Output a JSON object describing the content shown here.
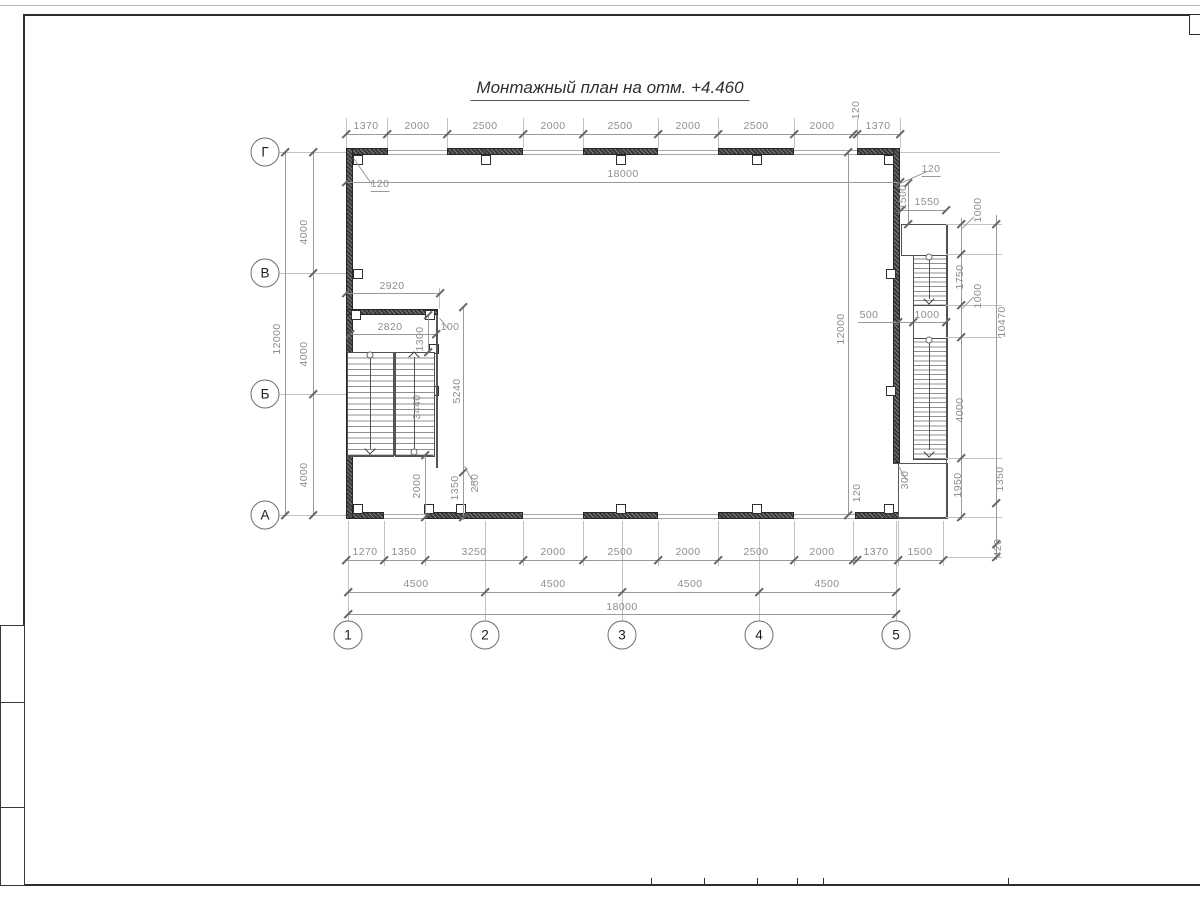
{
  "header": {
    "title": "Монтажный план на отм. +4.460"
  },
  "axes": {
    "rows": [
      {
        "label": "Г",
        "x": 265,
        "y": 152
      },
      {
        "label": "В",
        "x": 265,
        "y": 273
      },
      {
        "label": "Б",
        "x": 265,
        "y": 394
      },
      {
        "label": "А",
        "x": 265,
        "y": 515
      }
    ],
    "cols": [
      {
        "label": "1",
        "x": 348,
        "y": 635
      },
      {
        "label": "2",
        "x": 485,
        "y": 635
      },
      {
        "label": "3",
        "x": 622,
        "y": 635
      },
      {
        "label": "4",
        "x": 759,
        "y": 635
      },
      {
        "label": "5",
        "x": 896,
        "y": 635
      }
    ]
  },
  "drawing": {
    "labels": [
      {
        "t": "1370",
        "x": 366,
        "y": 126
      },
      {
        "t": "2000",
        "x": 417,
        "y": 126
      },
      {
        "t": "2500",
        "x": 485,
        "y": 126
      },
      {
        "t": "2000",
        "x": 553,
        "y": 126
      },
      {
        "t": "2500",
        "x": 620,
        "y": 126
      },
      {
        "t": "2000",
        "x": 688,
        "y": 126
      },
      {
        "t": "2500",
        "x": 756,
        "y": 126
      },
      {
        "t": "2000",
        "x": 822,
        "y": 126
      },
      {
        "t": "120",
        "x": 856,
        "y": 110,
        "r": 1
      },
      {
        "t": "1370",
        "x": 878,
        "y": 126
      },
      {
        "t": "18000",
        "x": 623,
        "y": 174
      },
      {
        "t": "120",
        "x": 380,
        "y": 185,
        "u": 1
      },
      {
        "t": "4000",
        "x": 304,
        "y": 232,
        "r": 1
      },
      {
        "t": "4000",
        "x": 304,
        "y": 354,
        "r": 1
      },
      {
        "t": "4000",
        "x": 304,
        "y": 475,
        "r": 1
      },
      {
        "t": "12000",
        "x": 277,
        "y": 339,
        "r": 1
      },
      {
        "t": "2920",
        "x": 392,
        "y": 286
      },
      {
        "t": "2820",
        "x": 390,
        "y": 327
      },
      {
        "t": "1300",
        "x": 420,
        "y": 339,
        "r": 1
      },
      {
        "t": "100",
        "x": 450,
        "y": 327
      },
      {
        "t": "3440",
        "x": 417,
        "y": 407,
        "r": 1
      },
      {
        "t": "5240",
        "x": 457,
        "y": 391,
        "r": 1
      },
      {
        "t": "2000",
        "x": 417,
        "y": 486,
        "r": 1
      },
      {
        "t": "1350",
        "x": 455,
        "y": 488,
        "r": 1
      },
      {
        "t": "250",
        "x": 475,
        "y": 483,
        "r": 1
      },
      {
        "t": "12000",
        "x": 841,
        "y": 329,
        "r": 1
      },
      {
        "t": "500",
        "x": 869,
        "y": 315
      },
      {
        "t": "1000",
        "x": 927,
        "y": 315
      },
      {
        "t": "120",
        "x": 931,
        "y": 170,
        "u": 1
      },
      {
        "t": "1500",
        "x": 903,
        "y": 197,
        "r": 1
      },
      {
        "t": "1550",
        "x": 927,
        "y": 202
      },
      {
        "t": "1000",
        "x": 978,
        "y": 210,
        "r": 1
      },
      {
        "t": "1750",
        "x": 960,
        "y": 277,
        "r": 1
      },
      {
        "t": "1000",
        "x": 978,
        "y": 296,
        "r": 1
      },
      {
        "t": "10470",
        "x": 1002,
        "y": 322,
        "r": 1
      },
      {
        "t": "4000",
        "x": 960,
        "y": 410,
        "r": 1
      },
      {
        "t": "1950",
        "x": 958,
        "y": 485,
        "r": 1
      },
      {
        "t": "300",
        "x": 905,
        "y": 480,
        "r": 1
      },
      {
        "t": "1350",
        "x": 1000,
        "y": 479,
        "r": 1
      },
      {
        "t": "120",
        "x": 857,
        "y": 493,
        "r": 1
      },
      {
        "t": "420",
        "x": 998,
        "y": 548,
        "r": 1
      },
      {
        "t": "1270",
        "x": 365,
        "y": 552
      },
      {
        "t": "1350",
        "x": 404,
        "y": 552
      },
      {
        "t": "3250",
        "x": 474,
        "y": 552
      },
      {
        "t": "2000",
        "x": 553,
        "y": 552
      },
      {
        "t": "2500",
        "x": 620,
        "y": 552
      },
      {
        "t": "2000",
        "x": 688,
        "y": 552
      },
      {
        "t": "2500",
        "x": 756,
        "y": 552
      },
      {
        "t": "2000",
        "x": 822,
        "y": 552
      },
      {
        "t": "1370",
        "x": 876,
        "y": 552
      },
      {
        "t": "1500",
        "x": 920,
        "y": 552
      },
      {
        "t": "4500",
        "x": 416,
        "y": 584
      },
      {
        "t": "4500",
        "x": 553,
        "y": 584
      },
      {
        "t": "4500",
        "x": 690,
        "y": 584
      },
      {
        "t": "4500",
        "x": 827,
        "y": 584
      },
      {
        "t": "18000",
        "x": 622,
        "y": 607
      }
    ],
    "dimlines": [
      {
        "o": "h",
        "x": 346,
        "y": 134,
        "l": 554,
        "tk": [
          346,
          387,
          447,
          523,
          583,
          658,
          718,
          794,
          853,
          857,
          900
        ]
      },
      {
        "o": "h",
        "x": 346,
        "y": 182,
        "l": 554,
        "tk": [
          346,
          900
        ]
      },
      {
        "o": "h",
        "x": 346,
        "y": 293,
        "l": 94,
        "tk": [
          346,
          440
        ]
      },
      {
        "o": "h",
        "x": 350,
        "y": 334,
        "l": 86,
        "tk": [
          350,
          436
        ]
      },
      {
        "o": "h",
        "x": 901,
        "y": 210,
        "l": 45,
        "tk": [
          901,
          946
        ]
      },
      {
        "o": "h",
        "x": 858,
        "y": 322,
        "l": 88,
        "tk": [
          898,
          913,
          946
        ]
      },
      {
        "o": "h",
        "x": 346,
        "y": 560,
        "l": 597,
        "tk": [
          346,
          384,
          425,
          523,
          583,
          658,
          718,
          794,
          853,
          857,
          898,
          943
        ]
      },
      {
        "o": "h",
        "x": 348,
        "y": 592,
        "l": 548,
        "tk": [
          348,
          485,
          622,
          759,
          896
        ]
      },
      {
        "o": "h",
        "x": 348,
        "y": 614,
        "l": 548,
        "tk": [
          348,
          896
        ]
      },
      {
        "o": "v",
        "x": 285,
        "y": 152,
        "l": 363,
        "tk": [
          152,
          515
        ]
      },
      {
        "o": "v",
        "x": 313,
        "y": 152,
        "l": 363,
        "tk": [
          152,
          273,
          394,
          515
        ]
      },
      {
        "o": "v",
        "x": 848,
        "y": 152,
        "l": 363,
        "tk": [
          152,
          515
        ]
      },
      {
        "o": "v",
        "x": 961,
        "y": 218,
        "l": 302,
        "tk": [
          224,
          254,
          305,
          337,
          458,
          517
        ]
      },
      {
        "o": "v",
        "x": 996,
        "y": 215,
        "l": 345,
        "tk": [
          224,
          503,
          544,
          557
        ]
      },
      {
        "o": "v",
        "x": 463,
        "y": 307,
        "l": 213,
        "tk": [
          307,
          472,
          517
        ]
      },
      {
        "o": "v",
        "x": 428,
        "y": 315,
        "l": 37,
        "tk": [
          315,
          352
        ]
      },
      {
        "o": "v",
        "x": 425,
        "y": 455,
        "l": 62,
        "tk": [
          455,
          517
        ]
      },
      {
        "o": "v",
        "x": 908,
        "y": 183,
        "l": 41,
        "tk": [
          183,
          224
        ]
      }
    ],
    "extlines": [
      {
        "o": "v",
        "x": 346,
        "y": 118,
        "l": 30
      },
      {
        "o": "v",
        "x": 387,
        "y": 118,
        "l": 30
      },
      {
        "o": "v",
        "x": 447,
        "y": 118,
        "l": 30
      },
      {
        "o": "v",
        "x": 523,
        "y": 118,
        "l": 30
      },
      {
        "o": "v",
        "x": 583,
        "y": 118,
        "l": 30
      },
      {
        "o": "v",
        "x": 658,
        "y": 118,
        "l": 30
      },
      {
        "o": "v",
        "x": 718,
        "y": 118,
        "l": 30
      },
      {
        "o": "v",
        "x": 794,
        "y": 118,
        "l": 30
      },
      {
        "o": "v",
        "x": 857,
        "y": 118,
        "l": 30
      },
      {
        "o": "v",
        "x": 900,
        "y": 118,
        "l": 30
      },
      {
        "o": "h",
        "x": 279,
        "y": 152,
        "l": 67
      },
      {
        "o": "h",
        "x": 279,
        "y": 273,
        "l": 67
      },
      {
        "o": "h",
        "x": 279,
        "y": 394,
        "l": 67
      },
      {
        "o": "h",
        "x": 279,
        "y": 515,
        "l": 67
      },
      {
        "o": "v",
        "x": 384,
        "y": 521,
        "l": 45
      },
      {
        "o": "v",
        "x": 425,
        "y": 521,
        "l": 45
      },
      {
        "o": "v",
        "x": 523,
        "y": 521,
        "l": 45
      },
      {
        "o": "v",
        "x": 583,
        "y": 521,
        "l": 45
      },
      {
        "o": "v",
        "x": 658,
        "y": 521,
        "l": 45
      },
      {
        "o": "v",
        "x": 718,
        "y": 521,
        "l": 45
      },
      {
        "o": "v",
        "x": 794,
        "y": 521,
        "l": 45
      },
      {
        "o": "v",
        "x": 853,
        "y": 521,
        "l": 45
      },
      {
        "o": "v",
        "x": 898,
        "y": 521,
        "l": 45
      },
      {
        "o": "v",
        "x": 943,
        "y": 521,
        "l": 45
      },
      {
        "o": "v",
        "x": 348,
        "y": 521,
        "l": 100
      },
      {
        "o": "v",
        "x": 485,
        "y": 521,
        "l": 100
      },
      {
        "o": "v",
        "x": 622,
        "y": 521,
        "l": 100
      },
      {
        "o": "v",
        "x": 759,
        "y": 521,
        "l": 100
      },
      {
        "o": "v",
        "x": 896,
        "y": 521,
        "l": 100
      },
      {
        "o": "h",
        "x": 946,
        "y": 224,
        "l": 56
      },
      {
        "o": "h",
        "x": 946,
        "y": 254,
        "l": 56
      },
      {
        "o": "h",
        "x": 946,
        "y": 305,
        "l": 56
      },
      {
        "o": "h",
        "x": 946,
        "y": 337,
        "l": 56
      },
      {
        "o": "h",
        "x": 946,
        "y": 458,
        "l": 56
      },
      {
        "o": "h",
        "x": 946,
        "y": 517,
        "l": 56
      },
      {
        "o": "h",
        "x": 900,
        "y": 152,
        "l": 100
      },
      {
        "o": "h",
        "x": 946,
        "y": 557,
        "l": 56
      },
      {
        "o": "v",
        "x": 439,
        "y": 288,
        "l": 21
      }
    ],
    "edges": [
      {
        "o": "h",
        "x": 898,
        "y": 463,
        "l": 48
      },
      {
        "o": "v",
        "x": 898,
        "y": 463,
        "l": 54
      },
      {
        "o": "h",
        "x": 898,
        "y": 517,
        "l": 48
      },
      {
        "o": "v",
        "x": 946,
        "y": 224,
        "l": 293
      },
      {
        "o": "h",
        "x": 893,
        "y": 463,
        "l": 20
      },
      {
        "o": "v",
        "x": 393,
        "y": 352,
        "l": 103,
        "t": 2
      },
      {
        "o": "v",
        "x": 436,
        "y": 315,
        "l": 153,
        "t": 2
      },
      {
        "o": "h",
        "x": 347,
        "y": 455,
        "l": 86
      }
    ],
    "dirlines": [
      {
        "o": "v",
        "x": 370,
        "y": 356,
        "l": 93
      },
      {
        "o": "v",
        "x": 414,
        "y": 357,
        "l": 95
      },
      {
        "o": "v",
        "x": 929,
        "y": 258,
        "l": 41
      },
      {
        "o": "v",
        "x": 929,
        "y": 341,
        "l": 109
      }
    ],
    "leaders": [
      {
        "x": 354,
        "y": 158,
        "l": 32,
        "deg": 55
      },
      {
        "x": 900,
        "y": 183,
        "l": 30,
        "deg": -24
      },
      {
        "x": 465,
        "y": 466,
        "l": 24,
        "deg": 62
      },
      {
        "x": 962,
        "y": 228,
        "l": 16,
        "deg": -45
      },
      {
        "x": 962,
        "y": 308,
        "l": 16,
        "deg": -45
      },
      {
        "x": 440,
        "y": 318,
        "l": 14,
        "deg": 50
      },
      {
        "x": 899,
        "y": 466,
        "l": 16,
        "deg": 60
      }
    ],
    "walls": [
      {
        "x": 346,
        "y": 148,
        "w": 42,
        "h": 7
      },
      {
        "x": 447,
        "y": 148,
        "w": 76,
        "h": 7
      },
      {
        "x": 583,
        "y": 148,
        "w": 75,
        "h": 7
      },
      {
        "x": 718,
        "y": 148,
        "w": 76,
        "h": 7
      },
      {
        "x": 857,
        "y": 148,
        "w": 43,
        "h": 7
      },
      {
        "x": 346,
        "y": 512,
        "w": 38,
        "h": 7
      },
      {
        "x": 425,
        "y": 512,
        "w": 98,
        "h": 7
      },
      {
        "x": 583,
        "y": 512,
        "w": 75,
        "h": 7
      },
      {
        "x": 718,
        "y": 512,
        "w": 76,
        "h": 7
      },
      {
        "x": 855,
        "y": 512,
        "w": 45,
        "h": 7
      },
      {
        "x": 346,
        "y": 148,
        "w": 7,
        "h": 371
      },
      {
        "x": 893,
        "y": 148,
        "w": 7,
        "h": 315
      },
      {
        "x": 346,
        "y": 309,
        "w": 92,
        "h": 6
      }
    ],
    "windows": [
      {
        "x": 388,
        "y": 150,
        "w": 59
      },
      {
        "x": 523,
        "y": 150,
        "w": 60
      },
      {
        "x": 658,
        "y": 150,
        "w": 60
      },
      {
        "x": 794,
        "y": 150,
        "w": 63
      },
      {
        "x": 384,
        "y": 514,
        "w": 41
      },
      {
        "x": 523,
        "y": 514,
        "w": 60
      },
      {
        "x": 658,
        "y": 514,
        "w": 60
      },
      {
        "x": 794,
        "y": 514,
        "w": 61
      }
    ],
    "columns": [
      {
        "x": 353,
        "y": 155
      },
      {
        "x": 481,
        "y": 155
      },
      {
        "x": 616,
        "y": 155
      },
      {
        "x": 752,
        "y": 155
      },
      {
        "x": 884,
        "y": 155
      },
      {
        "x": 353,
        "y": 504
      },
      {
        "x": 424,
        "y": 504
      },
      {
        "x": 456,
        "y": 504
      },
      {
        "x": 616,
        "y": 504
      },
      {
        "x": 752,
        "y": 504
      },
      {
        "x": 884,
        "y": 504
      },
      {
        "x": 353,
        "y": 269
      },
      {
        "x": 353,
        "y": 386
      },
      {
        "x": 886,
        "y": 269
      },
      {
        "x": 886,
        "y": 386
      },
      {
        "x": 351,
        "y": 310
      },
      {
        "x": 425,
        "y": 310
      },
      {
        "x": 429,
        "y": 344
      },
      {
        "x": 429,
        "y": 386
      }
    ],
    "flights": [
      {
        "x": 347,
        "y": 352,
        "w": 45,
        "h": 103,
        "s": 5.7
      },
      {
        "x": 395,
        "y": 352,
        "w": 38,
        "h": 103,
        "s": 5.7
      },
      {
        "x": 913,
        "y": 254,
        "w": 33,
        "h": 51,
        "s": 4.6
      },
      {
        "x": 913,
        "y": 337,
        "w": 33,
        "h": 121,
        "s": 4.65
      }
    ],
    "landings": [
      {
        "x": 901,
        "y": 224,
        "w": 45,
        "h": 30
      },
      {
        "x": 913,
        "y": 305,
        "w": 33,
        "h": 32
      },
      {
        "x": 898,
        "y": 463,
        "w": 48,
        "h": 54
      }
    ],
    "dots": [
      {
        "x": 370,
        "y": 355
      },
      {
        "x": 414,
        "y": 452
      },
      {
        "x": 929,
        "y": 257
      },
      {
        "x": 929,
        "y": 340
      }
    ],
    "chevrons": [
      {
        "x": 370,
        "y": 449,
        "d": "dn"
      },
      {
        "x": 414,
        "y": 357,
        "d": "up"
      },
      {
        "x": 929,
        "y": 299,
        "d": "dn"
      },
      {
        "x": 929,
        "y": 452,
        "d": "dn"
      }
    ]
  },
  "frame": {
    "pagelines": [
      {
        "o": "h",
        "x": 0,
        "y": 5,
        "l": 1200
      }
    ],
    "framelines": [
      {
        "o": "h",
        "x": 23,
        "y": 14,
        "l": 1177
      },
      {
        "o": "v",
        "x": 23,
        "y": 14,
        "l": 871
      },
      {
        "o": "h",
        "x": 0,
        "y": 884,
        "l": 1200
      }
    ],
    "corner_box": {
      "x": 1189,
      "y": 14,
      "w": 11,
      "h": 19
    },
    "left_cells": [
      {
        "x": 0,
        "y": 625,
        "w": 23,
        "h": 77
      },
      {
        "x": 0,
        "y": 702,
        "w": 23,
        "h": 105
      },
      {
        "x": 0,
        "y": 807,
        "w": 23,
        "h": 77
      }
    ],
    "bottom_ticks": [
      651,
      704,
      757,
      797,
      823,
      1008
    ]
  }
}
